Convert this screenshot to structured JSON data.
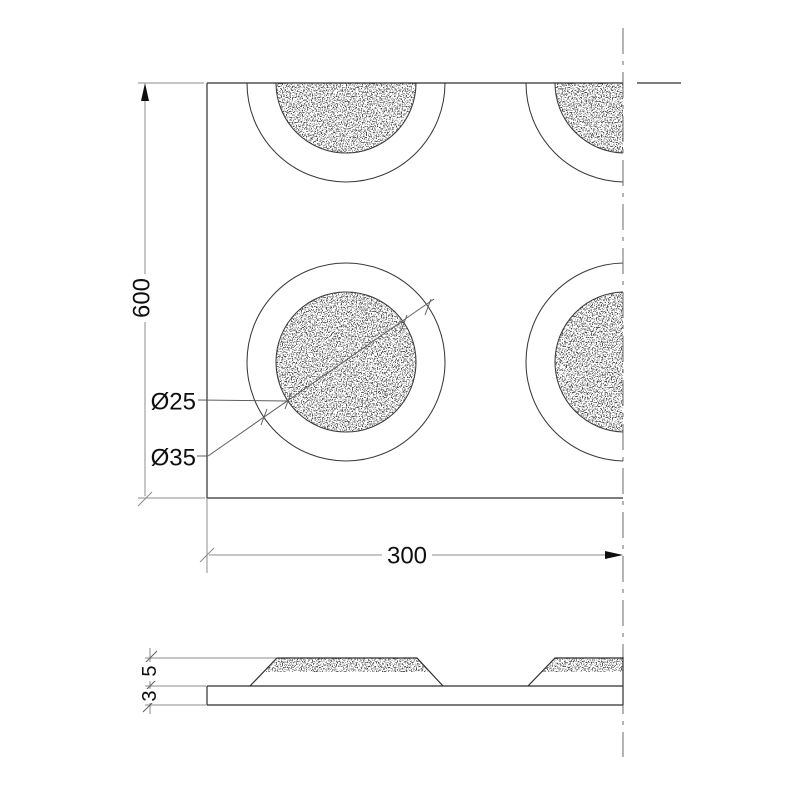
{
  "drawing": {
    "type": "technical-detail-drawing",
    "views": {
      "plan": "tactile dome grid plan view",
      "section": "plate side profile with dome bumps"
    },
    "labels": {
      "height": "600",
      "width": "300",
      "dome_top_diameter": "Ø25",
      "dome_base_diameter": "Ø35",
      "dome_height": "5",
      "plate_thickness": "3"
    },
    "colors": {
      "background": "#ffffff",
      "object_line": "#2e2e2e",
      "arc_line": "#3a3a3a",
      "dim_line": "#8c8c8c",
      "leader_line": "#5f5f5f",
      "centerline": "#686868",
      "text": "#0f0f0f"
    }
  }
}
